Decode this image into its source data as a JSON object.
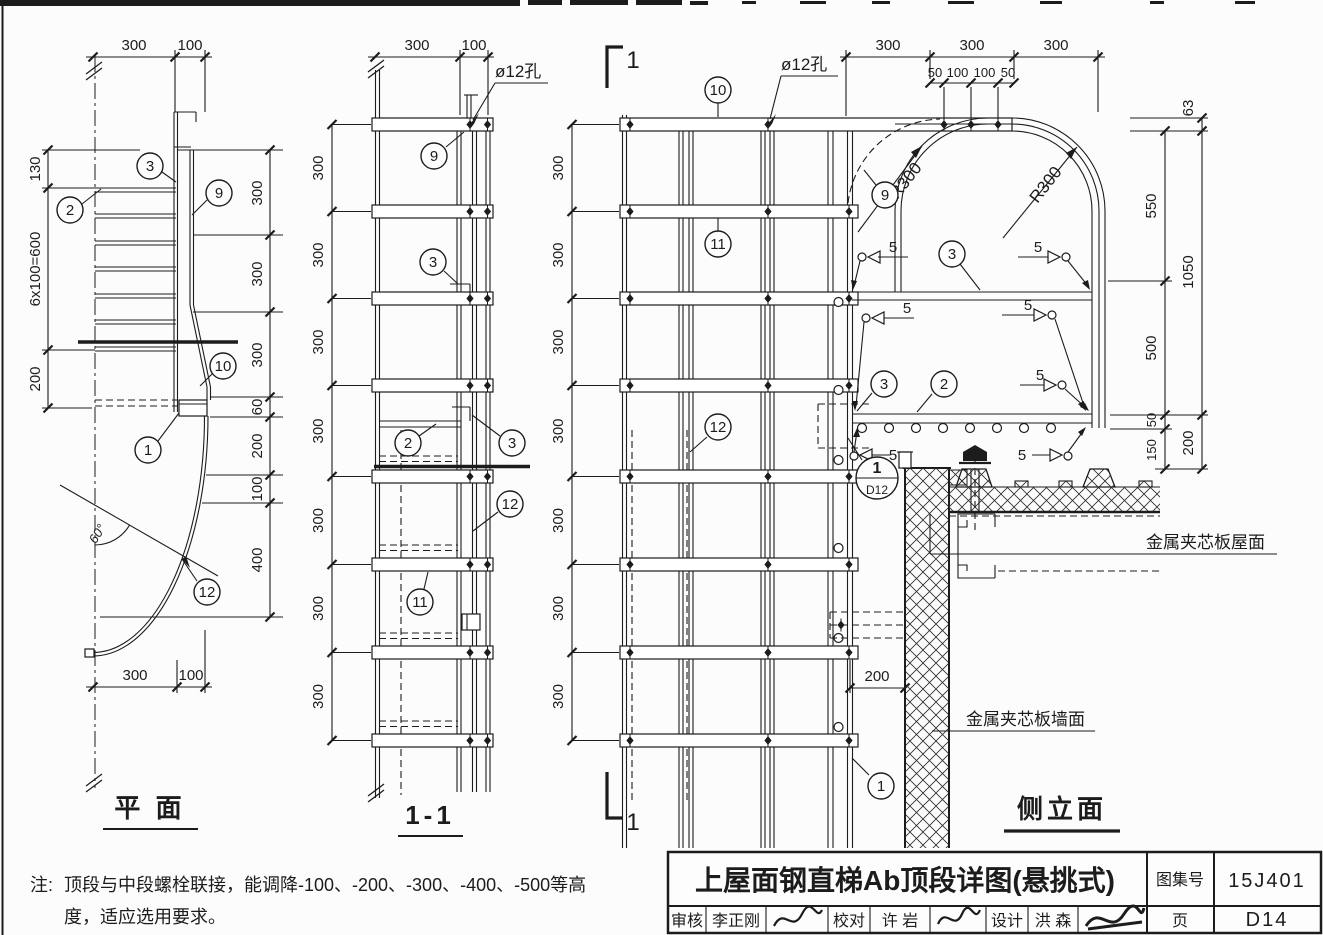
{
  "views": {
    "plan": {
      "title": "平 面",
      "dims_top": [
        "300",
        "100"
      ],
      "dims_left": [
        "130",
        "6x100=600",
        "200"
      ],
      "dims_right": [
        "300",
        "300",
        "300",
        "60",
        "200",
        "100",
        "400"
      ],
      "dims_bottom": [
        "300",
        "100"
      ],
      "angle": "60°",
      "callouts": {
        "c1": "1",
        "c2": "2",
        "c3": "3",
        "c9": "9",
        "c10": "10",
        "c12": "12"
      }
    },
    "section": {
      "title": "1-1",
      "hole": "ø12孔",
      "dims_top": [
        "300",
        "100"
      ],
      "dims_left": [
        "300",
        "300",
        "300",
        "300",
        "300",
        "300",
        "300"
      ],
      "marker_top": "1",
      "marker_bottom": "1",
      "callouts": {
        "c9": "9",
        "c3a": "3",
        "c2": "2",
        "c3b": "3",
        "c12": "12",
        "c11": "11"
      }
    },
    "elevation": {
      "title": "侧立面",
      "hole": "ø12孔",
      "dims_top": [
        "300",
        "300",
        "300"
      ],
      "dims_top2": [
        "50",
        "100",
        "100",
        "50"
      ],
      "dims_left": [
        "300",
        "300",
        "300",
        "300",
        "300",
        "300",
        "300"
      ],
      "dims_right_inner": [
        "550",
        "500",
        "50",
        "150"
      ],
      "dims_right_outer": [
        "63",
        "1050",
        "200"
      ],
      "dim_wall": "200",
      "r300_left": "R300",
      "r300_right": "R300",
      "welds": [
        "5",
        "5",
        "5",
        "5",
        "5",
        "5",
        "5"
      ],
      "roof_label": "金属夹芯板屋面",
      "wall_label": "金属夹芯板墙面",
      "detail": {
        "num": "1",
        "sheet": "D12"
      },
      "callouts": {
        "c10": "10",
        "c9": "9",
        "c11": "11",
        "c3a": "3",
        "c3b": "3",
        "c2": "2",
        "c12": "12",
        "c1": "1"
      }
    }
  },
  "note": {
    "prefix": "注:",
    "line1": "顶段与中段螺栓联接，能调降-100、-200、-300、-400、-500等高",
    "line2": "度，适应选用要求。"
  },
  "title_block": {
    "title": "上屋面钢直梯Ab顶段详图(悬挑式)",
    "atlas_label": "图集号",
    "atlas_no": "15J401",
    "page_label": "页",
    "page_no": "D14",
    "audit_label": "审核",
    "audit_name": "李正刚",
    "check_label": "校对",
    "check_name": "许 岩",
    "design_label": "设计",
    "design_name": "洪 森"
  }
}
